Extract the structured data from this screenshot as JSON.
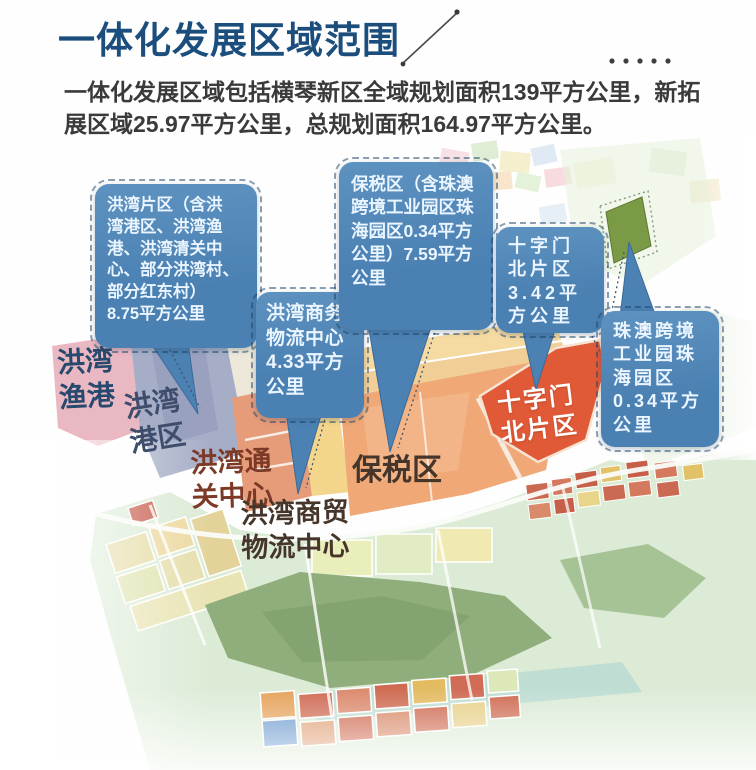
{
  "header": {
    "title": "一体化发展区域范围"
  },
  "intro": {
    "text": "一体化发展区域包括横琴新区全域规划面积139平方公里，新拓\n展区域25.97平方公里，总规划面积164.97平方公里。"
  },
  "callouts": [
    {
      "id": "hongwan-district",
      "text": "洪湾片区（含洪\n湾港区、洪湾渔\n港、洪湾清关中\n心、部分洪湾村、\n部分红东村）\n8.75平方公里"
    },
    {
      "id": "hongwan-business-logistics",
      "text": "洪湾商务\n物流中心\n4.33平方\n公里"
    },
    {
      "id": "bonded-zone",
      "text": "保税区（含珠澳\n跨境工业园区珠\n海园区0.34平方\n公里）7.59平方\n公里"
    },
    {
      "id": "shizimen-north",
      "text": "十字门\n北片区\n3.42平\n方公里"
    },
    {
      "id": "zhuao-cross-border-park",
      "text": "珠澳跨境\n工业园珠\n海园区\n0.34平方\n公里"
    }
  ],
  "map_labels": [
    {
      "id": "hongwan-fishing-port",
      "text": "洪湾\n渔港"
    },
    {
      "id": "hongwan-port-area",
      "text": "洪湾\n港区"
    },
    {
      "id": "hongwan-customs-center",
      "text": "洪湾通\n关中心"
    },
    {
      "id": "hongwan-trade-logistics-center",
      "text": "洪湾商贸\n物流中心"
    },
    {
      "id": "bonded-zone-map-label",
      "text": "保税区"
    },
    {
      "id": "shizimen-north-map-label",
      "text": "十字门\n北片区"
    }
  ],
  "colors": {
    "title_blue": "#1b4e7d",
    "body_text": "#3a3a3a",
    "callout_blue": "#4a80b2",
    "callout_blue_light": "#5d92c0",
    "callout_text": "#eaf5ff",
    "shizimen_red": "#e05a38",
    "bonded_orange": "#efa876",
    "port_slate": "#a6aec7",
    "fishing_pink": "#eab8c2",
    "peninsula_green": "#dcebd6",
    "label_navy": "#27496e",
    "label_slate": "#3d4d6b",
    "label_rust": "#7c3a26",
    "label_brown": "#46352a"
  }
}
